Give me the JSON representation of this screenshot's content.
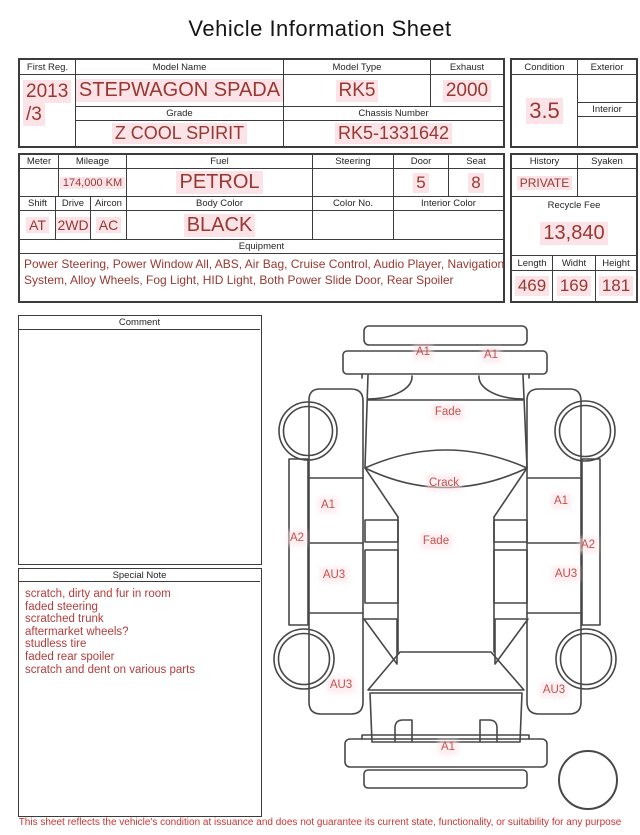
{
  "title": "Vehicle Information Sheet",
  "registration": {
    "first_reg_label": "First Reg.",
    "first_reg_line1": "2013",
    "first_reg_line2": "/3",
    "model_name_label": "Model Name",
    "model_name": "STEPWAGON SPADA",
    "model_type_label": "Model Type",
    "model_type": "RK5",
    "exhaust_label": "Exhaust",
    "exhaust": "2000",
    "grade_label": "Grade",
    "grade": "Z COOL SPIRIT",
    "chassis_label": "Chassis Number",
    "chassis_number": "RK5-1331642"
  },
  "condition_box": {
    "condition_label": "Condition",
    "score": "3.5",
    "exterior_label": "Exterior",
    "exterior": "",
    "interior_label": "Interior",
    "interior": ""
  },
  "spec_box": {
    "meter_label": "Meter",
    "meter": "",
    "mileage_label": "Mileage",
    "mileage": "174,000 KM",
    "fuel_label": "Fuel",
    "fuel": "PETROL",
    "steering_label": "Steering",
    "steering": "",
    "door_label": "Door",
    "door": "5",
    "seat_label": "Seat",
    "seat": "8",
    "shift_label": "Shift",
    "shift": "AT",
    "drive_label": "Drive",
    "drive": "2WD",
    "aircon_label": "Aircon",
    "aircon": "AC",
    "body_color_label": "Body Color",
    "body_color": "BLACK",
    "color_no_label": "Color No.",
    "color_no": "",
    "interior_color_label": "Interior Color",
    "interior_color": ""
  },
  "history_box": {
    "history_label": "History",
    "history": "PRIVATE",
    "syaken_label": "Syaken",
    "syaken": "",
    "recycle_fee_label": "Recycle Fee",
    "recycle_fee": "13,840",
    "length_label": "Length",
    "length": "469",
    "width_label": "Widht",
    "width": "169",
    "height_label": "Height",
    "height": "181"
  },
  "equipment_box": {
    "label": "Equipment",
    "text": "Power Steering, Power Window  All, ABS, Air Bag, Cruise Control, Audio Player, Navigation System, Alloy Wheels, Fog Light, HID Light, Both Power Slide Door, Rear Spoiler"
  },
  "comment_box": {
    "label": "Comment",
    "text": ""
  },
  "special_note_box": {
    "label": "Special Note",
    "lines": [
      "scratch, dirty and fur in room",
      "faded steering",
      "scratched trunk",
      "aftermarket wheels?",
      "studless tire",
      "faded rear spoiler",
      "scratch and dent on various parts"
    ]
  },
  "diagram": {
    "labels": [
      {
        "id": "a1-front-bumper-left",
        "text": "A1",
        "x": 155,
        "y": 37
      },
      {
        "id": "a1-front-bumper-right",
        "text": "A1",
        "x": 223,
        "y": 40
      },
      {
        "id": "fade-hood",
        "text": "Fade",
        "x": 180,
        "y": 97
      },
      {
        "id": "crack-windshield",
        "text": "Crack",
        "x": 176,
        "y": 168
      },
      {
        "id": "a1-front-door-left",
        "text": "A1",
        "x": 60,
        "y": 190
      },
      {
        "id": "a1-front-door-right",
        "text": "A1",
        "x": 293,
        "y": 186
      },
      {
        "id": "a2-sill-left",
        "text": "A2",
        "x": 29,
        "y": 223
      },
      {
        "id": "fade-roof",
        "text": "Fade",
        "x": 168,
        "y": 226
      },
      {
        "id": "a2-sill-right",
        "text": "A2",
        "x": 320,
        "y": 230
      },
      {
        "id": "au3-slide-door-left",
        "text": "AU3",
        "x": 66,
        "y": 260
      },
      {
        "id": "au3-slide-door-right",
        "text": "AU3",
        "x": 298,
        "y": 259
      },
      {
        "id": "au3-quarter-left",
        "text": "AU3",
        "x": 73,
        "y": 370
      },
      {
        "id": "au3-quarter-right",
        "text": "AU3",
        "x": 286,
        "y": 375
      },
      {
        "id": "a1-rear-bumper",
        "text": "A1",
        "x": 180,
        "y": 432
      }
    ]
  },
  "footer": {
    "disclaimer": "This sheet reflects the vehicle's condition at issuance and does not guarantee its current state, functionality, or suitability for any purpose"
  },
  "colors": {
    "value_red": "#993831",
    "diagram_label_red": "#c4524c",
    "note_red": "#b43c3c",
    "footer_red": "#cc3434",
    "highlight_pink": "#fbe3e8",
    "line": "#3c3c3c"
  }
}
